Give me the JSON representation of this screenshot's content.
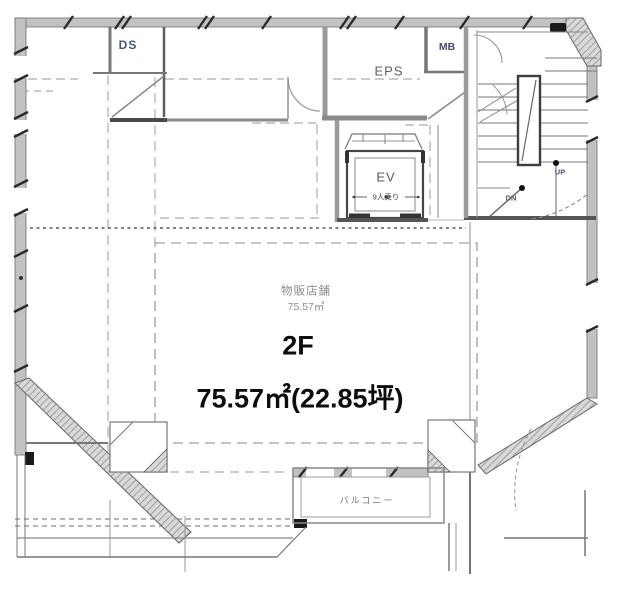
{
  "title": {
    "floor": "2F",
    "area": "75.57㎡(22.85坪)"
  },
  "rooms": {
    "retail": {
      "name": "物販店舗",
      "area": "75.57㎡"
    },
    "elevator": {
      "label": "EV",
      "capacity": "9人乗り"
    },
    "stairs": {
      "up": "UP",
      "down": "DN"
    },
    "duct": "DS",
    "eps": "EPS",
    "mailbox": "MB",
    "balcony": "バルコニー"
  },
  "colors": {
    "wall_fill": "#c2c2c2",
    "wall_edge": "#6e6e6e",
    "line": "#777777",
    "dashed": "#a8a8a8",
    "room_label": "#4a5578",
    "main_text": "#0d0d0d",
    "muted_text": "#8d8d8d"
  }
}
